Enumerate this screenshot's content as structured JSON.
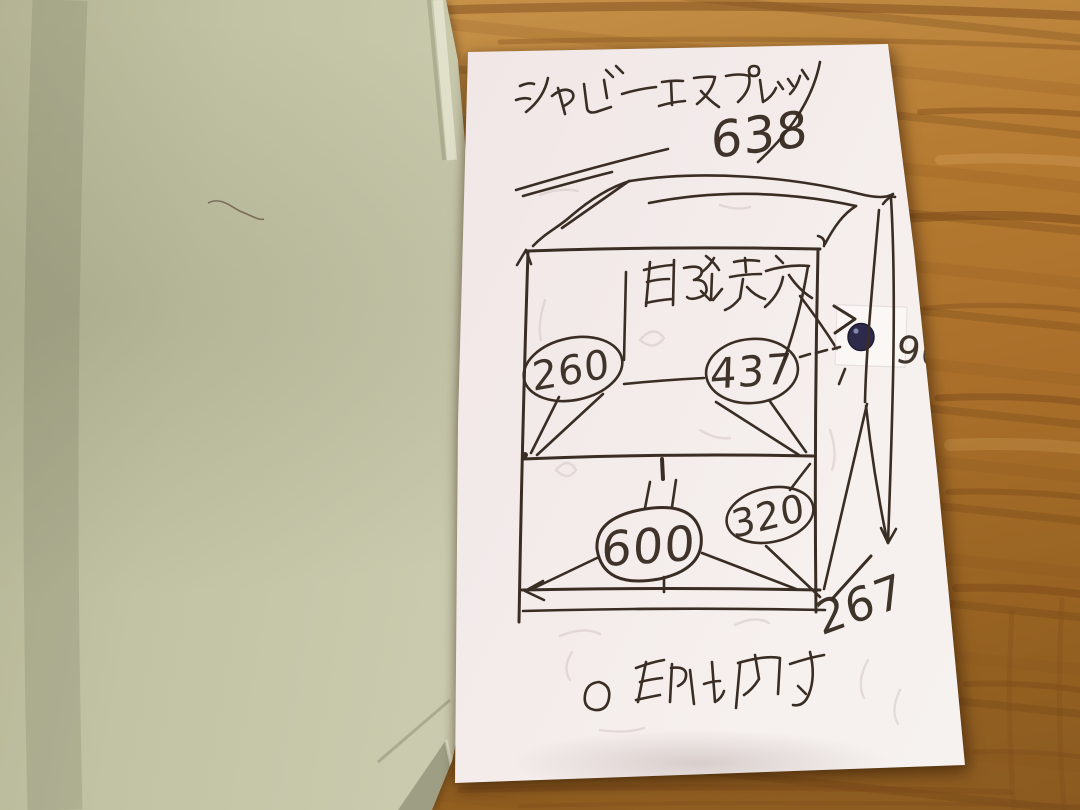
{
  "note": {
    "title": "シャビーエスプレッソ",
    "labels": {
      "wiring_hole": "配線穴",
      "legend": "〇印は内寸"
    },
    "dimensions": {
      "top_width": "638",
      "upper_shelf_left": "260",
      "upper_shelf_right": "437",
      "lower_shelf_width": "600",
      "lower_shelf_right": "320",
      "side_height": "900",
      "depth": "267"
    }
  },
  "colors": {
    "paper": "#f1e8e7",
    "envelope": "#c9c9ad",
    "wood": "#b5762f",
    "ink": "#3a2d24",
    "hole_ink": "#2e2a4c"
  }
}
